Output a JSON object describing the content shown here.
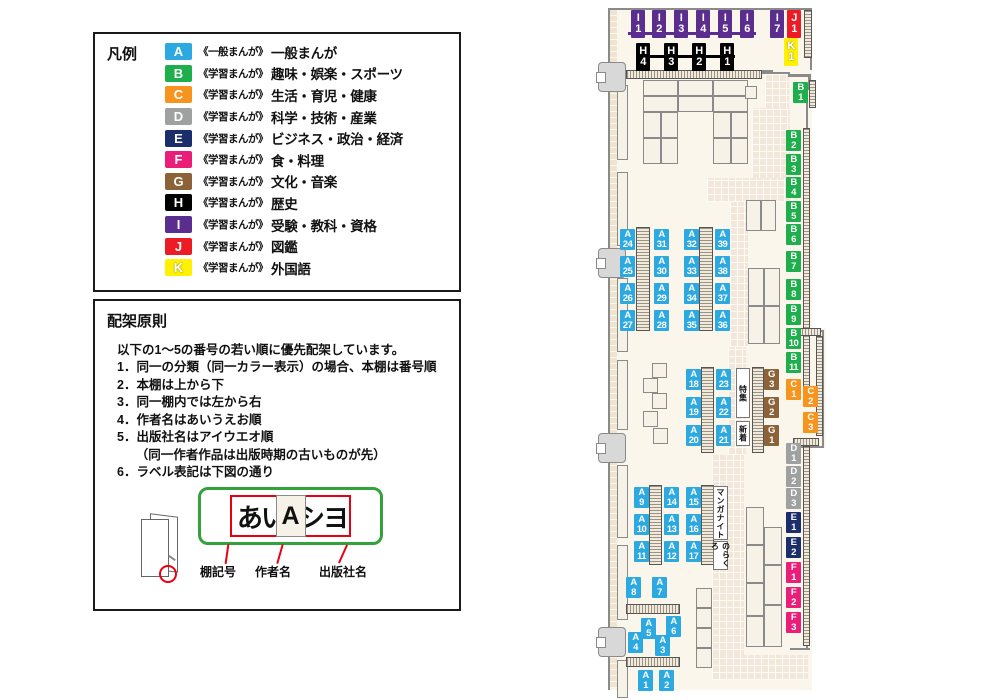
{
  "legend": {
    "title": "凡例",
    "items": [
      {
        "code": "A",
        "color": "#2BA9E0",
        "type": "《一般まんが》",
        "category": "一般まんが",
        "outline": false
      },
      {
        "code": "B",
        "color": "#1EAF4C",
        "type": "《学習まんが》",
        "category": "趣味・娯楽・スポーツ",
        "outline": false
      },
      {
        "code": "C",
        "color": "#F7941E",
        "type": "《学習まんが》",
        "category": "生活・育児・健康",
        "outline": false
      },
      {
        "code": "D",
        "color": "#9FA0A0",
        "type": "《学習まんが》",
        "category": "科学・技術・産業",
        "outline": false
      },
      {
        "code": "E",
        "color": "#1B2D6B",
        "type": "《学習まんが》",
        "category": "ビジネス・政治・経済",
        "outline": false
      },
      {
        "code": "F",
        "color": "#EA1E79",
        "type": "《学習まんが》",
        "category": "食・料理",
        "outline": false
      },
      {
        "code": "G",
        "color": "#8C6239",
        "type": "《学習まんが》",
        "category": "文化・音楽",
        "outline": false
      },
      {
        "code": "H",
        "color": "#000000",
        "type": "《学習まんが》",
        "category": "歴史",
        "outline": false
      },
      {
        "code": "I",
        "color": "#5B2D8E",
        "type": "《学習まんが》",
        "category": "受験・教科・資格",
        "outline": false
      },
      {
        "code": "J",
        "color": "#ED1C24",
        "type": "《学習まんが》",
        "category": "図鑑",
        "outline": false
      },
      {
        "code": "K",
        "color": "#FFF100",
        "type": "《学習まんが》",
        "category": "外国語",
        "outline": true
      }
    ]
  },
  "principles": {
    "title": "配架原則",
    "intro": "以下の1～5の番号の若い順に優先配架しています。",
    "items": [
      "1．同一の分類（同一カラー表示）の場合、本棚は番号順",
      "2．本棚は上から下",
      "3．同一棚内では左から右",
      "4．作者名はあいうえお順",
      "5．出版社名はアイウエオ順",
      "　　（同一作者作品は出版時期の古いものが先）",
      "6．ラベル表記は下図の通り"
    ],
    "label_example": {
      "shelf": "A",
      "author": "あい",
      "publisher": "シヨ",
      "captions": [
        "棚記号",
        "作者名",
        "出版社名"
      ]
    }
  },
  "map": {
    "colors": {
      "A": "#2BA9E0",
      "B": "#1EAF4C",
      "C": "#F7941E",
      "D": "#9FA0A0",
      "E": "#1B2D6B",
      "F": "#EA1E79",
      "G": "#8C6239",
      "H": "#000000",
      "I": "#5B2D8E",
      "J": "#ED1C24",
      "K": "#FFF100"
    },
    "floor": [
      [
        608,
        8,
        204,
        682
      ],
      [
        812,
        328,
        14,
        120
      ]
    ],
    "wallfills": [
      [
        610,
        10,
        7,
        678
      ]
    ],
    "walkways": [
      [
        765,
        74,
        24,
        36
      ],
      [
        752,
        108,
        38,
        72
      ],
      [
        707,
        178,
        83,
        24
      ],
      [
        730,
        202,
        18,
        145
      ],
      [
        728,
        347,
        18,
        108
      ],
      [
        712,
        455,
        32,
        202
      ],
      [
        712,
        655,
        96,
        25
      ]
    ],
    "walls": [
      [
        608,
        8,
        2,
        682
      ],
      [
        608,
        8,
        204,
        2
      ],
      [
        810,
        8,
        2,
        62
      ],
      [
        745,
        70,
        28,
        3
      ],
      [
        762,
        72,
        28,
        2
      ],
      [
        788,
        74,
        22,
        3
      ],
      [
        808,
        74,
        3,
        16
      ],
      [
        806,
        88,
        2,
        242
      ],
      [
        806,
        330,
        18,
        2
      ],
      [
        822,
        330,
        2,
        118
      ],
      [
        800,
        446,
        24,
        2
      ],
      [
        806,
        448,
        2,
        200
      ],
      [
        790,
        648,
        20,
        2
      ]
    ],
    "lines": [
      {
        "x": 628,
        "y": 32,
        "w": 128,
        "h": 3,
        "c": "I"
      },
      {
        "x": 638,
        "y": 55,
        "w": 97,
        "h": 3,
        "c": "H"
      }
    ],
    "shelves": [
      [
        643,
        80,
        35,
        16
      ],
      [
        678,
        80,
        35,
        16
      ],
      [
        713,
        80,
        35,
        16
      ],
      [
        643,
        96,
        35,
        16
      ],
      [
        678,
        96,
        35,
        16
      ],
      [
        713,
        96,
        35,
        16
      ],
      [
        643,
        112,
        18,
        26
      ],
      [
        661,
        112,
        17,
        26
      ],
      [
        713,
        112,
        18,
        26
      ],
      [
        731,
        112,
        17,
        26
      ],
      [
        643,
        138,
        18,
        26
      ],
      [
        661,
        138,
        17,
        26
      ],
      [
        713,
        138,
        18,
        26
      ],
      [
        731,
        138,
        17,
        26
      ],
      [
        745,
        86,
        12,
        13
      ],
      [
        746,
        200,
        15,
        31
      ],
      [
        761,
        200,
        15,
        31
      ],
      [
        748,
        268,
        16,
        38
      ],
      [
        748,
        306,
        16,
        38
      ],
      [
        764,
        268,
        16,
        38
      ],
      [
        764,
        306,
        16,
        38
      ],
      [
        746,
        507,
        18,
        38
      ],
      [
        746,
        545,
        18,
        38
      ],
      [
        746,
        583,
        18,
        33
      ],
      [
        746,
        616,
        18,
        31
      ],
      [
        764,
        527,
        18,
        38
      ],
      [
        764,
        565,
        18,
        40
      ],
      [
        764,
        605,
        18,
        42
      ],
      [
        696,
        588,
        16,
        20
      ],
      [
        696,
        608,
        16,
        20
      ],
      [
        696,
        628,
        16,
        20
      ],
      [
        696,
        648,
        16,
        20
      ],
      [
        652,
        363,
        15,
        15
      ],
      [
        643,
        378,
        15,
        15
      ],
      [
        652,
        393,
        15,
        16
      ],
      [
        643,
        411,
        15,
        16
      ],
      [
        653,
        428,
        15,
        16
      ],
      [
        617,
        85,
        11,
        75
      ],
      [
        617,
        172,
        11,
        74
      ],
      [
        617,
        278,
        11,
        74
      ],
      [
        617,
        360,
        11,
        70
      ],
      [
        617,
        465,
        11,
        73
      ],
      [
        617,
        545,
        11,
        75
      ],
      [
        617,
        660,
        11,
        38
      ]
    ],
    "strips": [
      {
        "x": 626,
        "y": 70,
        "w": 136,
        "h": 9,
        "o": "h"
      },
      {
        "x": 804,
        "y": 10,
        "w": 8,
        "h": 48,
        "o": "v"
      },
      {
        "x": 809,
        "y": 80,
        "w": 7,
        "h": 28,
        "o": "v"
      },
      {
        "x": 803,
        "y": 128,
        "w": 7,
        "h": 272,
        "o": "v"
      },
      {
        "x": 795,
        "y": 328,
        "w": 26,
        "h": 8,
        "o": "h"
      },
      {
        "x": 816,
        "y": 336,
        "w": 7,
        "h": 100,
        "o": "v"
      },
      {
        "x": 793,
        "y": 438,
        "w": 26,
        "h": 8,
        "o": "h"
      },
      {
        "x": 803,
        "y": 446,
        "w": 7,
        "h": 200,
        "o": "v"
      },
      {
        "x": 636,
        "y": 227,
        "w": 14,
        "h": 104,
        "o": "v"
      },
      {
        "x": 699,
        "y": 227,
        "w": 14,
        "h": 104,
        "o": "v"
      },
      {
        "x": 701,
        "y": 367,
        "w": 13,
        "h": 86,
        "o": "v"
      },
      {
        "x": 752,
        "y": 367,
        "w": 12,
        "h": 86,
        "o": "v"
      },
      {
        "x": 649,
        "y": 485,
        "w": 13,
        "h": 80,
        "o": "v"
      },
      {
        "x": 701,
        "y": 485,
        "w": 13,
        "h": 80,
        "o": "v"
      },
      {
        "x": 626,
        "y": 604,
        "w": 54,
        "h": 10,
        "o": "h"
      },
      {
        "x": 626,
        "y": 657,
        "w": 54,
        "h": 10,
        "o": "h"
      }
    ],
    "doors": [
      [
        598,
        62
      ],
      [
        598,
        248
      ],
      [
        598,
        433
      ],
      [
        598,
        627
      ]
    ],
    "panels": [
      {
        "name": "special-feature-panel",
        "text": "特集",
        "x": 736,
        "y": 368,
        "w": 14,
        "h": 50
      },
      {
        "name": "new-arrivals-panel",
        "text": "新着",
        "x": 736,
        "y": 421,
        "w": 14,
        "h": 25
      },
      {
        "name": "manga-night-panel",
        "text": "マンガナイト",
        "x": 713,
        "y": 486,
        "w": 15,
        "h": 54
      },
      {
        "name": "norakuro-panel",
        "text": "のらくろ",
        "x": 713,
        "y": 541,
        "w": 15,
        "h": 29
      }
    ],
    "labels": [
      {
        "t": "I",
        "n": "1",
        "x": 631,
        "y": 10,
        "big": true
      },
      {
        "t": "I",
        "n": "2",
        "x": 652,
        "y": 10,
        "big": true
      },
      {
        "t": "I",
        "n": "3",
        "x": 674,
        "y": 10,
        "big": true
      },
      {
        "t": "I",
        "n": "4",
        "x": 696,
        "y": 10,
        "big": true
      },
      {
        "t": "I",
        "n": "5",
        "x": 718,
        "y": 10,
        "big": true
      },
      {
        "t": "I",
        "n": "6",
        "x": 740,
        "y": 10,
        "big": true
      },
      {
        "t": "I",
        "n": "7",
        "x": 770,
        "y": 10,
        "big": true
      },
      {
        "t": "J",
        "n": "1",
        "x": 787,
        "y": 10,
        "big": true
      },
      {
        "t": "K",
        "n": "1",
        "x": 784,
        "y": 38,
        "big": true
      },
      {
        "t": "H",
        "n": "4",
        "x": 636,
        "y": 43,
        "big": true
      },
      {
        "t": "H",
        "n": "3",
        "x": 664,
        "y": 43,
        "big": true
      },
      {
        "t": "H",
        "n": "2",
        "x": 692,
        "y": 43,
        "big": true
      },
      {
        "t": "H",
        "n": "1",
        "x": 720,
        "y": 43,
        "big": true
      },
      {
        "t": "B",
        "n": "1",
        "x": 793,
        "y": 82
      },
      {
        "t": "B",
        "n": "2",
        "x": 786,
        "y": 130
      },
      {
        "t": "B",
        "n": "3",
        "x": 786,
        "y": 154
      },
      {
        "t": "B",
        "n": "4",
        "x": 786,
        "y": 177
      },
      {
        "t": "B",
        "n": "5",
        "x": 786,
        "y": 201
      },
      {
        "t": "B",
        "n": "6",
        "x": 786,
        "y": 224
      },
      {
        "t": "B",
        "n": "7",
        "x": 786,
        "y": 251
      },
      {
        "t": "B",
        "n": "8",
        "x": 786,
        "y": 279
      },
      {
        "t": "B",
        "n": "9",
        "x": 786,
        "y": 304
      },
      {
        "t": "B",
        "n": "10",
        "x": 786,
        "y": 328
      },
      {
        "t": "B",
        "n": "11",
        "x": 786,
        "y": 352
      },
      {
        "t": "C",
        "n": "1",
        "x": 786,
        "y": 379
      },
      {
        "t": "C",
        "n": "2",
        "x": 803,
        "y": 386
      },
      {
        "t": "C",
        "n": "3",
        "x": 803,
        "y": 412
      },
      {
        "t": "D",
        "n": "1",
        "x": 786,
        "y": 443
      },
      {
        "t": "D",
        "n": "2",
        "x": 786,
        "y": 466
      },
      {
        "t": "D",
        "n": "3",
        "x": 786,
        "y": 488
      },
      {
        "t": "E",
        "n": "1",
        "x": 786,
        "y": 512
      },
      {
        "t": "E",
        "n": "2",
        "x": 786,
        "y": 537
      },
      {
        "t": "F",
        "n": "1",
        "x": 786,
        "y": 562
      },
      {
        "t": "F",
        "n": "2",
        "x": 786,
        "y": 587
      },
      {
        "t": "F",
        "n": "3",
        "x": 786,
        "y": 612
      },
      {
        "t": "A",
        "n": "24",
        "x": 620,
        "y": 229
      },
      {
        "t": "A",
        "n": "25",
        "x": 620,
        "y": 256
      },
      {
        "t": "A",
        "n": "26",
        "x": 620,
        "y": 283
      },
      {
        "t": "A",
        "n": "27",
        "x": 620,
        "y": 310
      },
      {
        "t": "A",
        "n": "31",
        "x": 654,
        "y": 229
      },
      {
        "t": "A",
        "n": "30",
        "x": 654,
        "y": 256
      },
      {
        "t": "A",
        "n": "29",
        "x": 654,
        "y": 283
      },
      {
        "t": "A",
        "n": "28",
        "x": 654,
        "y": 310
      },
      {
        "t": "A",
        "n": "32",
        "x": 684,
        "y": 229
      },
      {
        "t": "A",
        "n": "33",
        "x": 684,
        "y": 256
      },
      {
        "t": "A",
        "n": "34",
        "x": 684,
        "y": 283
      },
      {
        "t": "A",
        "n": "35",
        "x": 684,
        "y": 310
      },
      {
        "t": "A",
        "n": "39",
        "x": 715,
        "y": 229
      },
      {
        "t": "A",
        "n": "38",
        "x": 715,
        "y": 256
      },
      {
        "t": "A",
        "n": "37",
        "x": 715,
        "y": 283
      },
      {
        "t": "A",
        "n": "36",
        "x": 715,
        "y": 310
      },
      {
        "t": "A",
        "n": "18",
        "x": 686,
        "y": 369
      },
      {
        "t": "A",
        "n": "19",
        "x": 686,
        "y": 397
      },
      {
        "t": "A",
        "n": "20",
        "x": 686,
        "y": 425
      },
      {
        "t": "A",
        "n": "23",
        "x": 716,
        "y": 369
      },
      {
        "t": "A",
        "n": "22",
        "x": 716,
        "y": 397
      },
      {
        "t": "A",
        "n": "21",
        "x": 716,
        "y": 425
      },
      {
        "t": "G",
        "n": "3",
        "x": 764,
        "y": 369
      },
      {
        "t": "G",
        "n": "2",
        "x": 764,
        "y": 397
      },
      {
        "t": "G",
        "n": "1",
        "x": 764,
        "y": 425
      },
      {
        "t": "A",
        "n": "9",
        "x": 634,
        "y": 487
      },
      {
        "t": "A",
        "n": "10",
        "x": 634,
        "y": 514
      },
      {
        "t": "A",
        "n": "11",
        "x": 634,
        "y": 541
      },
      {
        "t": "A",
        "n": "14",
        "x": 664,
        "y": 487
      },
      {
        "t": "A",
        "n": "13",
        "x": 664,
        "y": 514
      },
      {
        "t": "A",
        "n": "12",
        "x": 664,
        "y": 541
      },
      {
        "t": "A",
        "n": "15",
        "x": 686,
        "y": 487
      },
      {
        "t": "A",
        "n": "16",
        "x": 686,
        "y": 514
      },
      {
        "t": "A",
        "n": "17",
        "x": 686,
        "y": 541
      },
      {
        "t": "A",
        "n": "8",
        "x": 626,
        "y": 577
      },
      {
        "t": "A",
        "n": "7",
        "x": 652,
        "y": 577
      },
      {
        "t": "A",
        "n": "5",
        "x": 641,
        "y": 618
      },
      {
        "t": "A",
        "n": "6",
        "x": 666,
        "y": 616
      },
      {
        "t": "A",
        "n": "4",
        "x": 628,
        "y": 632
      },
      {
        "t": "A",
        "n": "3",
        "x": 655,
        "y": 635
      },
      {
        "t": "A",
        "n": "1",
        "x": 638,
        "y": 670
      },
      {
        "t": "A",
        "n": "2",
        "x": 659,
        "y": 670
      }
    ]
  }
}
